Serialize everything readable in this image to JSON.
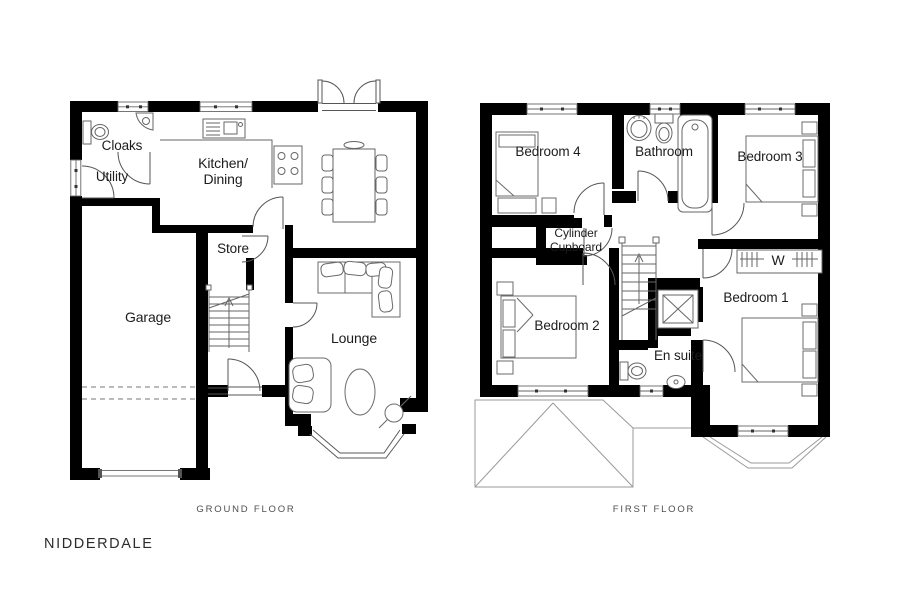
{
  "title": "NIDDERDALE",
  "colors": {
    "wall": "#000000",
    "thin_line": "#5a5a5a",
    "furniture_line": "#6b6b6b",
    "roof_line": "#9a9a9a",
    "text": "#1c1c1c",
    "caption": "#4f4f4f"
  },
  "ground_floor": {
    "caption": "GROUND FLOOR",
    "rooms": {
      "cloaks": {
        "label": "Cloaks"
      },
      "utility": {
        "label": "Utility"
      },
      "kitchen_dining": {
        "line1": "Kitchen/",
        "line2": "Dining"
      },
      "store": {
        "label": "Store"
      },
      "garage": {
        "label": "Garage"
      },
      "lounge": {
        "label": "Lounge"
      }
    }
  },
  "first_floor": {
    "caption": "FIRST FLOOR",
    "rooms": {
      "bedroom4": {
        "label": "Bedroom 4"
      },
      "bathroom": {
        "label": "Bathroom"
      },
      "bedroom3": {
        "label": "Bedroom 3"
      },
      "cylinder_cupboard": {
        "line1": "Cylinder",
        "line2": "Cupboard"
      },
      "wardrobe": {
        "label": "W"
      },
      "bedroom2": {
        "label": "Bedroom 2"
      },
      "bedroom1": {
        "label": "Bedroom 1"
      },
      "ensuite": {
        "label": "En suite"
      }
    }
  }
}
